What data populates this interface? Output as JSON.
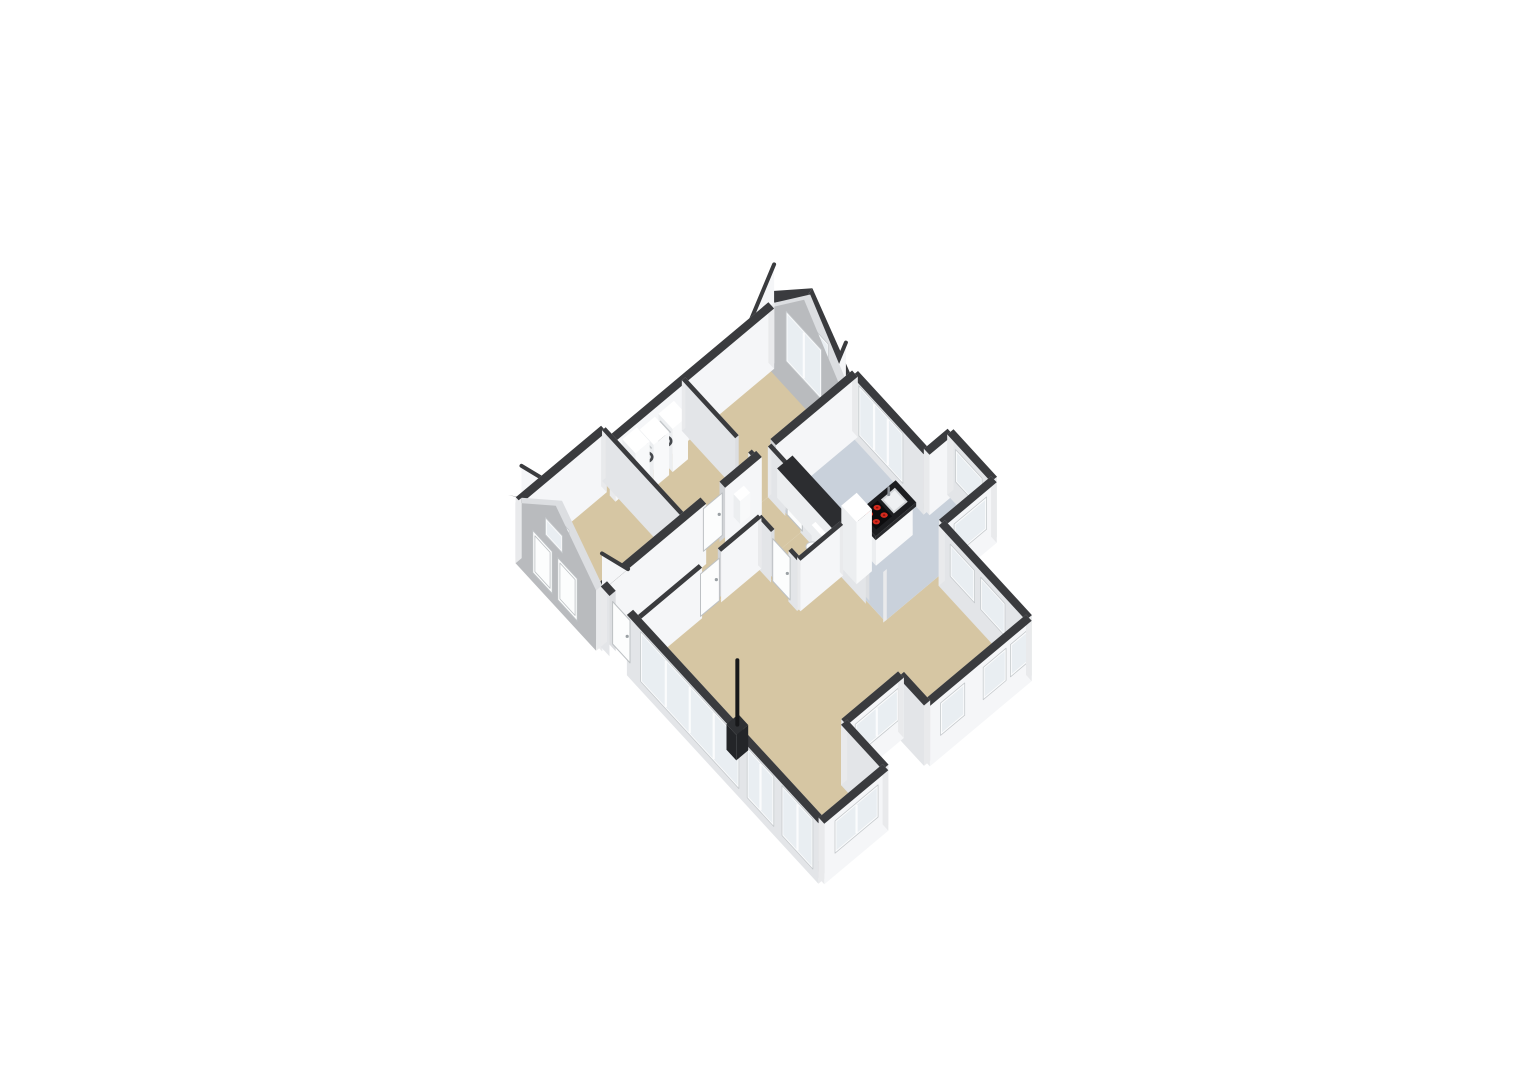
{
  "view": {
    "width": 1527,
    "height": 1080,
    "background": "#ffffff"
  },
  "colors": {
    "bg": "#ffffff",
    "wallTop": "#3a3b3e",
    "faceS": "#f5f6f8",
    "faceW": "#e3e5e8",
    "faceN": "#d1d3d6",
    "faceE": "#dcdee1",
    "gableGray": "#b9bbbe",
    "cap": "#e9eaec",
    "floorTan": "#d6c6a3",
    "floorBlue": "#c9d1db",
    "glass": "#e9eef2",
    "winFrame": "#fbfcfd",
    "winEdge": "#c6cacd",
    "leaf": "#fcfdfd",
    "leafEdge": "#bdc1c4",
    "boxW": "#eceef0",
    "boxS": "#f8f9fa",
    "boxT": "#ffffff",
    "islandDark": "#1c1d20",
    "slabW": "#232427",
    "slabS": "#2a2b2e",
    "counterTop": "#2c2d30",
    "cooktop": "#0c0c0e",
    "burner": "#d62b1e",
    "burnerDark": "#8c1410",
    "sinkRim": "#d3d6d9",
    "sinkIn": "#eef0f2",
    "faucet": "#8b9197",
    "flue": "#17181a",
    "stoveSide": "#232528",
    "stoveTop": "#2e3033",
    "washerRing": "#45484c",
    "washerIn": "#d2d5d8",
    "washerKnob": "#9198a0"
  },
  "scene": {
    "projection": {
      "ox": 480,
      "oy": 600,
      "ax": 0.74,
      "ay": -0.62,
      "bx": 0.68,
      "by": 0.74,
      "zs": 1.02,
      "s": 32
    },
    "floors": [
      {
        "name": "floor-bedroom",
        "color": "floorTan",
        "pts": [
          [
            8.6,
            0
          ],
          [
            12.3,
            0
          ],
          [
            12.3,
            3.3
          ],
          [
            8.6,
            3.3
          ]
        ]
      },
      {
        "name": "floor-utility",
        "color": "floorTan",
        "pts": [
          [
            5.6,
            0
          ],
          [
            8.6,
            0
          ],
          [
            8.6,
            3.3
          ],
          [
            5.6,
            3.3
          ]
        ]
      },
      {
        "name": "floor-garage",
        "color": "floorTan",
        "pts": [
          [
            2.0,
            -0.4
          ],
          [
            5.6,
            -0.4
          ],
          [
            5.6,
            3.3
          ],
          [
            2.0,
            3.3
          ]
        ]
      },
      {
        "name": "floor-hallway",
        "color": "floorTan",
        "pts": [
          [
            2.2,
            3.3
          ],
          [
            9.2,
            3.3
          ],
          [
            9.2,
            4.8
          ],
          [
            2.2,
            4.8
          ]
        ]
      },
      {
        "name": "floor-toilet",
        "color": "floorTan",
        "pts": [
          [
            7.4,
            4.8
          ],
          [
            9.2,
            4.8
          ],
          [
            9.2,
            6.6
          ],
          [
            7.4,
            6.6
          ]
        ]
      },
      {
        "name": "floor-living-dining",
        "color": "floorTan",
        "pts": [
          [
            2.2,
            4.8
          ],
          [
            7.4,
            4.8
          ],
          [
            7.4,
            6.6
          ],
          [
            9.2,
            6.6
          ],
          [
            9.2,
            8.6
          ],
          [
            11.6,
            8.6
          ],
          [
            11.6,
            12.6
          ],
          [
            7.3,
            12.6
          ],
          [
            7.3,
            11.4
          ],
          [
            4.9,
            11.4
          ],
          [
            4.9,
            13.3
          ],
          [
            2.2,
            13.3
          ]
        ]
      },
      {
        "name": "floor-kitchen",
        "color": "floorBlue",
        "pts": [
          [
            9.2,
            3.3
          ],
          [
            12.8,
            3.3
          ],
          [
            12.8,
            6.6
          ],
          [
            13.8,
            6.6
          ],
          [
            13.8,
            8.6
          ],
          [
            9.2,
            8.6
          ]
        ]
      }
    ],
    "walls": [
      {
        "name": "wall-band-north",
        "p1": [
          5.6,
          0
        ],
        "p2": [
          12.3,
          0
        ],
        "t": 0.26,
        "base": -0.3
      },
      {
        "name": "wall-bedroom-gable-east",
        "p1": [
          12.3,
          0
        ],
        "p2": [
          12.3,
          3.3
        ],
        "t": 0.26,
        "base": -0.3,
        "gable": 3.0,
        "out": 1,
        "gray": true,
        "windows": [
          {
            "a0": 0.9,
            "a1": 2.4,
            "z0": 0.6,
            "z1": 2.0,
            "p": 2
          }
        ]
      },
      {
        "name": "wall-garage-north",
        "p1": [
          2.0,
          -0.4
        ],
        "p2": [
          5.6,
          -0.4
        ],
        "t": 0.26,
        "base": -0.3
      },
      {
        "name": "wall-garage-gable-west",
        "p1": [
          2.0,
          -0.4
        ],
        "p2": [
          2.0,
          3.3
        ],
        "t": 0.26,
        "base": -0.3,
        "gable": 2.8,
        "out": -1,
        "gray": true,
        "windows": [
          {
            "a0": 1.45,
            "a1": 2.1,
            "z0": 1.65,
            "z1": 2.05,
            "p": 1
          }
        ],
        "facedoors": [
          {
            "a0": 0.8,
            "a1": 1.7,
            "z0": 0,
            "z1": 1.3
          },
          {
            "a0": 1.95,
            "a1": 2.85,
            "z0": 0,
            "z1": 1.3
          }
        ]
      },
      {
        "name": "wall-band-south",
        "p1": [
          2.0,
          3.3
        ],
        "p2": [
          12.8,
          3.3
        ],
        "t": 0.26,
        "base": -0.3,
        "openings": [
          {
            "a0": 4.4,
            "a1": 5.2,
            "leaf": true
          },
          {
            "a0": 6.75,
            "a1": 7.35
          }
        ]
      },
      {
        "name": "wall-west",
        "p1": [
          2.2,
          3.3
        ],
        "p2": [
          2.2,
          13.3
        ],
        "t": 0.26,
        "base": -0.3,
        "openings": [
          {
            "a0": 0.4,
            "a1": 1.2,
            "leaf": true
          }
        ],
        "windows": [
          {
            "a0": 1.9,
            "a1": 6.3,
            "z0": 0.04,
            "z1": 1.45,
            "p": 4
          },
          {
            "a0": 6.8,
            "a1": 7.9,
            "z0": 0.04,
            "z1": 1.45,
            "p": 2
          },
          {
            "a0": 8.4,
            "a1": 9.7,
            "z0": 0.04,
            "z1": 1.45,
            "p": 2
          }
        ]
      },
      {
        "name": "wall-bump-south",
        "p1": [
          2.2,
          13.3
        ],
        "p2": [
          4.9,
          13.3
        ],
        "t": 0.26,
        "base": -0.3,
        "windows": [
          {
            "a0": 0.5,
            "a1": 2.2,
            "z0": 0.45,
            "z1": 1.32,
            "p": 2
          }
        ]
      },
      {
        "name": "wall-bump-east",
        "p1": [
          4.9,
          13.3
        ],
        "p2": [
          4.9,
          11.4
        ],
        "t": 0.26,
        "base": -0.3
      },
      {
        "name": "wall-living-south",
        "p1": [
          4.9,
          11.4
        ],
        "p2": [
          7.3,
          11.4
        ],
        "t": 0.26,
        "base": -0.3,
        "windows": [
          {
            "a0": 0.4,
            "a1": 2.1,
            "z0": 0.45,
            "z1": 1.32,
            "p": 2
          }
        ]
      },
      {
        "name": "wall-step-east",
        "p1": [
          7.3,
          11.4
        ],
        "p2": [
          7.3,
          12.6
        ],
        "t": 0.26,
        "base": -0.3
      },
      {
        "name": "wall-dining-south",
        "p1": [
          7.3,
          12.6
        ],
        "p2": [
          11.6,
          12.6
        ],
        "t": 0.26,
        "base": -0.3,
        "windows": [
          {
            "a0": 0.5,
            "a1": 1.4,
            "z0": 0.45,
            "z1": 1.32,
            "p": 1
          },
          {
            "a0": 2.3,
            "a1": 3.15,
            "z0": 0.45,
            "z1": 1.32,
            "p": 1
          },
          {
            "a0": 3.45,
            "a1": 4.1,
            "z0": 0.45,
            "z1": 1.32,
            "p": 1
          }
        ]
      },
      {
        "name": "wall-dining-east",
        "p1": [
          11.6,
          12.6
        ],
        "p2": [
          11.6,
          8.6
        ],
        "t": 0.26,
        "base": -0.3,
        "windows": [
          {
            "a0": 1.0,
            "a1": 2.0,
            "z0": 0.45,
            "z1": 1.32,
            "p": 1
          },
          {
            "a0": 2.4,
            "a1": 3.4,
            "z0": 0.45,
            "z1": 1.32,
            "p": 1
          }
        ]
      },
      {
        "name": "wall-kitchen-south",
        "p1": [
          11.6,
          8.6
        ],
        "p2": [
          13.8,
          8.6
        ],
        "t": 0.26,
        "base": -0.3,
        "windows": [
          {
            "a0": 0.45,
            "a1": 1.7,
            "z0": 0.45,
            "z1": 1.32,
            "p": 1
          }
        ]
      },
      {
        "name": "wall-entry-east",
        "p1": [
          13.8,
          8.6
        ],
        "p2": [
          13.8,
          6.6
        ],
        "t": 0.26,
        "base": -0.3,
        "windows": [
          {
            "a0": 0.45,
            "a1": 1.55,
            "z0": 0.45,
            "z1": 1.32,
            "p": 1
          }
        ]
      },
      {
        "name": "wall-entry-north",
        "p1": [
          13.8,
          6.6
        ],
        "p2": [
          12.8,
          6.6
        ],
        "t": 0.26,
        "base": -0.3
      },
      {
        "name": "wall-kitchen-east",
        "p1": [
          12.8,
          6.6
        ],
        "p2": [
          12.8,
          3.3
        ],
        "t": 0.26,
        "base": -0.3,
        "windows": [
          {
            "a0": 1.0,
            "a1": 2.9,
            "z0": 0.04,
            "z1": 1.45,
            "p": 3
          }
        ]
      },
      {
        "name": "wall-garage-utility",
        "p1": [
          5.6,
          -0.4
        ],
        "p2": [
          5.6,
          3.3
        ],
        "t": 0.15
      },
      {
        "name": "wall-utility-bedroom",
        "p1": [
          8.6,
          0
        ],
        "p2": [
          8.6,
          3.3
        ],
        "t": 0.15,
        "openings": [
          {
            "a0": 2.45,
            "a1": 3.05
          }
        ]
      },
      {
        "name": "wall-hall-living",
        "p1": [
          2.2,
          4.8
        ],
        "p2": [
          7.4,
          4.8
        ],
        "t": 0.15,
        "openings": [
          {
            "a0": 2.7,
            "a1": 3.5,
            "leaf": true
          }
        ]
      },
      {
        "name": "wall-toilet-west",
        "p1": [
          7.4,
          4.8
        ],
        "p2": [
          7.4,
          6.6
        ],
        "t": 0.15,
        "openings": [
          {
            "a0": 0.6,
            "a1": 1.4,
            "leaf": true
          }
        ]
      },
      {
        "name": "wall-toilet-south",
        "p1": [
          7.4,
          6.6
        ],
        "p2": [
          9.2,
          6.6
        ],
        "t": 0.15
      },
      {
        "name": "wall-living-kitchen",
        "p1": [
          9.2,
          3.3
        ],
        "p2": [
          9.2,
          8.6
        ],
        "t": 0.15,
        "openings": [
          {
            "a0": 0.8,
            "a1": 1.5,
            "leaf": true
          },
          {
            "a0": 4.5,
            "a1": 5.3
          }
        ]
      }
    ],
    "quads": [
      {
        "name": "roof-edge-bedroom-north",
        "fill": "wallTop",
        "kbias": 3,
        "pts": [
          [
            12.24,
            -0.18,
            1.5
          ],
          [
            12.24,
            1.65,
            3.0
          ],
          [
            12.52,
            1.65,
            3.14
          ],
          [
            12.52,
            -0.34,
            1.6
          ]
        ]
      },
      {
        "name": "roof-edge-bedroom-south",
        "fill": "wallTop",
        "kbias": 3,
        "pts": [
          [
            12.24,
            3.48,
            1.5
          ],
          [
            12.24,
            1.65,
            3.0
          ],
          [
            12.52,
            1.65,
            3.14
          ],
          [
            12.52,
            3.64,
            1.6
          ]
        ]
      },
      {
        "name": "roof-edge-garage-north",
        "fill": "wallTop",
        "kbias": 3,
        "pts": [
          [
            2.06,
            -0.58,
            1.5
          ],
          [
            2.06,
            1.45,
            2.8
          ],
          [
            1.78,
            1.45,
            2.94
          ],
          [
            1.78,
            -0.74,
            1.6
          ]
        ]
      },
      {
        "name": "roof-edge-garage-south",
        "fill": "wallTop",
        "kbias": 3,
        "pts": [
          [
            2.06,
            3.48,
            1.5
          ],
          [
            2.06,
            1.45,
            2.8
          ],
          [
            1.78,
            1.45,
            2.94
          ],
          [
            1.78,
            3.64,
            1.6
          ]
        ]
      }
    ],
    "tris": [
      {
        "name": "gable-rise-bedroom-north",
        "fill": "faceS",
        "edge": true,
        "kbias": 2,
        "pts": [
          [
            11.1,
            0.13,
            1.55
          ],
          [
            12.3,
            0.13,
            1.55
          ],
          [
            12.3,
            0.13,
            2.9
          ]
        ]
      },
      {
        "name": "gable-rise-bedroom-south",
        "fill": "faceS",
        "edge": true,
        "kbias": 2,
        "pts": [
          [
            11.1,
            3.43,
            1.55
          ],
          [
            12.3,
            3.43,
            1.55
          ],
          [
            12.3,
            3.43,
            2.9
          ]
        ]
      },
      {
        "name": "gable-rise-garage-north",
        "fill": "faceS",
        "edge": true,
        "kbias": 2,
        "pts": [
          [
            3.1,
            -0.27,
            1.55
          ],
          [
            2.0,
            -0.27,
            1.55
          ],
          [
            2.0,
            -0.27,
            2.7
          ]
        ]
      },
      {
        "name": "gable-rise-garage-south",
        "fill": "faceS",
        "edge": true,
        "kbias": 2,
        "pts": [
          [
            3.1,
            3.43,
            1.55
          ],
          [
            2.0,
            3.43,
            1.55
          ],
          [
            2.0,
            3.43,
            2.7
          ]
        ]
      }
    ],
    "furniture": [
      {
        "name": "utility-cabinet",
        "type": "box",
        "x0": 5.85,
        "y0": 0.18,
        "x1": 6.45,
        "y1": 0.78,
        "z0": 0,
        "z1": 1.5
      },
      {
        "name": "washing-machine-1",
        "type": "washer",
        "x0": 6.6,
        "y0": 0.15,
        "x1": 7.25,
        "y1": 0.8,
        "z0": 0,
        "z1": 1.32
      },
      {
        "name": "washing-machine-2",
        "type": "washer",
        "x0": 7.4,
        "y0": 0.15,
        "x1": 8.05,
        "y1": 0.8,
        "z0": 0,
        "z1": 1.32
      },
      {
        "name": "kitchen-counter",
        "type": "counter",
        "x0": 9.33,
        "y0": 3.5,
        "x1": 9.98,
        "y1": 6.3,
        "z0": 0,
        "z1": 0.9
      },
      {
        "name": "kitchen-tall-cabinet",
        "type": "box",
        "x0": 9.33,
        "y0": 6.45,
        "x1": 9.98,
        "y1": 7.15,
        "z0": 0,
        "z1": 1.9
      },
      {
        "name": "kitchen-island",
        "type": "island",
        "x0": 10.2,
        "y0": 6.3,
        "x1": 11.75,
        "y1": 7.1,
        "z0": 0,
        "z1": 0.88
      },
      {
        "name": "toilet",
        "type": "toilet",
        "x0": 9.0,
        "y0": 5.45,
        "x1": 9.16,
        "y1": 5.95,
        "z0": 0,
        "z1": 0.78
      },
      {
        "name": "wood-stove",
        "type": "stove",
        "x0": 2.6,
        "y0": 8.5,
        "x1": 3.1,
        "y1": 8.95,
        "z0": 0,
        "z1": 0.78
      },
      {
        "name": "boiler",
        "type": "box",
        "x0": 7.55,
        "y0": 3.44,
        "x1": 7.98,
        "y1": 3.74,
        "z0": 0.45,
        "z1": 1.15
      }
    ]
  }
}
